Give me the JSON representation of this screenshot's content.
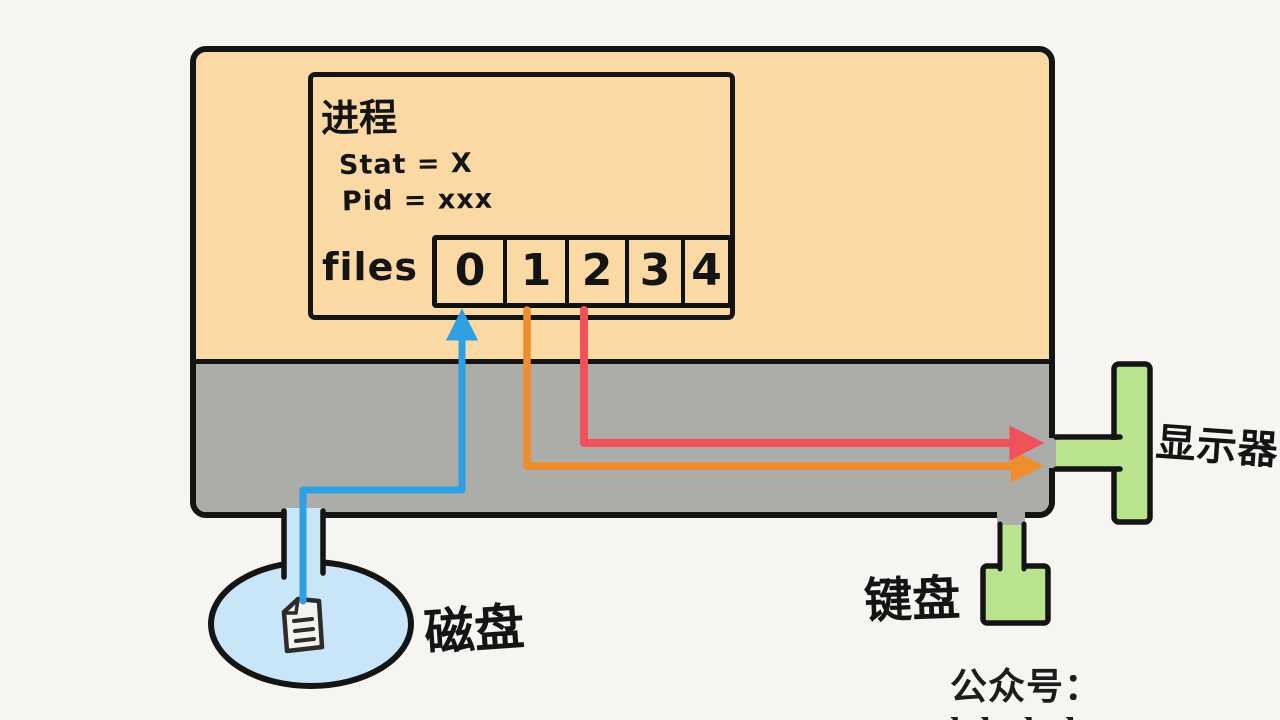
{
  "background_color": "#F7F5F1",
  "kernel_box": {
    "user_space_color": "#FAD9A4",
    "kernel_space_color": "#ACACA8"
  },
  "process_box": {
    "title": "进程",
    "stat_line": "Stat = X",
    "pid_line": "Pid = xxx",
    "files_label": "files",
    "file_descriptors": [
      "0",
      "1",
      "2",
      "3",
      "4"
    ]
  },
  "devices": {
    "disk_label": "磁盘",
    "display_label": "显示器",
    "keyboard_label": "键盘",
    "disk_color": "#C9E5F8",
    "device_color": "#B9E48D",
    "document_icon": "document-with-lines"
  },
  "arrows": {
    "fd0_disk_color": "#2D9FE3",
    "fd1_display_color": "#EE8D2B",
    "fd2_display_color": "#F1515A"
  },
  "footer": {
    "watermark": "公众号：labuladong"
  }
}
